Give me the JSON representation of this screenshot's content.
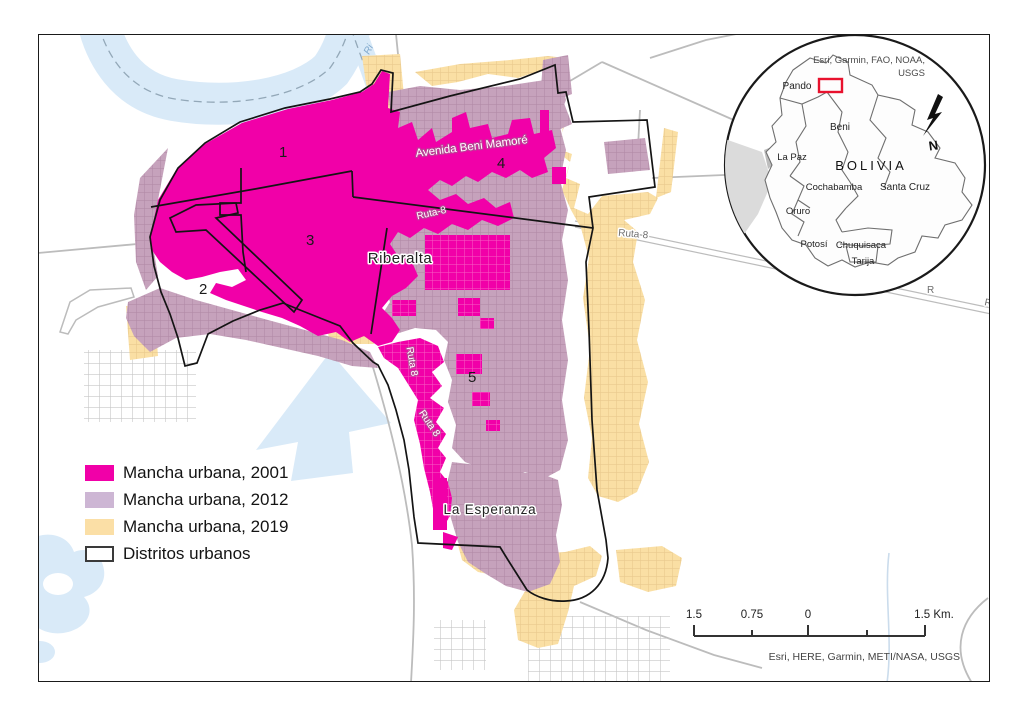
{
  "map": {
    "credits": "Esri, HERE, Garmin, METI/NASA, USGS",
    "labels": {
      "city": "Riberalta",
      "neighborhood": "La Esperanza",
      "avenue": "Avenida Beni Mamoré",
      "route_white": "Ruta-8",
      "route_vertical_1": "Ruta 8",
      "route_vertical_2": "Ruta 8",
      "route_gray": "Ruta-8",
      "route_fragment_1": "R",
      "route_fragment_2": "R.",
      "river_fragment": "Ri",
      "districts": [
        "1",
        "2",
        "3",
        "4",
        "5"
      ]
    },
    "colors": {
      "urban_2001": "#F100A8",
      "urban_2012": "#C6A2BC",
      "urban_2019": "#FADFA4",
      "district_outline": "#141414",
      "water": "#D9EAF8",
      "road": "#BCBCBC"
    }
  },
  "legend": {
    "items": [
      {
        "label": "Mancha urbana, 2001",
        "color": "#F100A8"
      },
      {
        "label": "Mancha urbana, 2012",
        "color": "#CDB6D4"
      },
      {
        "label": "Mancha urbana, 2019",
        "color": "#FBDFA6"
      },
      {
        "label": "Distritos urbanos",
        "color": "#FFFFFF"
      }
    ]
  },
  "inset": {
    "credits_line1": "Esri, Garmin, FAO, NOAA,",
    "credits_line2": "USGS",
    "country": "BOLIVIA",
    "north": "N",
    "highlight_color": "#E8112D",
    "departments": [
      "Pando",
      "Beni",
      "La Paz",
      "Cochabamba",
      "Santa Cruz",
      "Oruro",
      "Potosí",
      "Chuquisaca",
      "Tarija"
    ]
  },
  "scalebar": {
    "ticks": [
      "1.5",
      "0.75",
      "0",
      "1.5 Km."
    ]
  }
}
